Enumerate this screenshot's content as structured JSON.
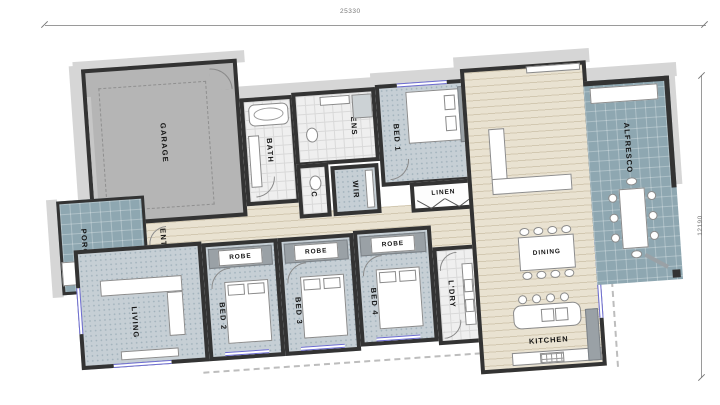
{
  "dimensions": {
    "top": "25330",
    "right": "12190"
  },
  "rooms": {
    "garage": {
      "label": "GARAGE"
    },
    "bath": {
      "label": "BATH"
    },
    "ens": {
      "label": "ENS"
    },
    "wc": {
      "label": "WC"
    },
    "wir": {
      "label": "WIR"
    },
    "bed1": {
      "label": "BED 1"
    },
    "linen": {
      "label": "LINEN"
    },
    "living_main": {
      "label": "LIVING"
    },
    "alfresco": {
      "label": "ALFRESCO"
    },
    "porch": {
      "label": "PORCH"
    },
    "entry": {
      "label": "ENTRY"
    },
    "living_front": {
      "label": "LIVING"
    },
    "bed2": {
      "label": "BED 2",
      "robe": "ROBE"
    },
    "bed3": {
      "label": "BED 3",
      "robe": "ROBE"
    },
    "bed4": {
      "label": "BED 4",
      "robe": "ROBE"
    },
    "laundry": {
      "label": "L'DRY"
    },
    "dining": {
      "label": "DINING"
    },
    "kitchen": {
      "label": "KITCHEN"
    }
  },
  "colors": {
    "wall": "#333333",
    "carpet": "#c6cfd5",
    "timber_floor": "#e9e2d1",
    "wet_area_tile": "#efefef",
    "outdoor_tile": "#8ea7b1",
    "garage_floor": "#b5b5b5",
    "window": "#6b6bd0"
  }
}
